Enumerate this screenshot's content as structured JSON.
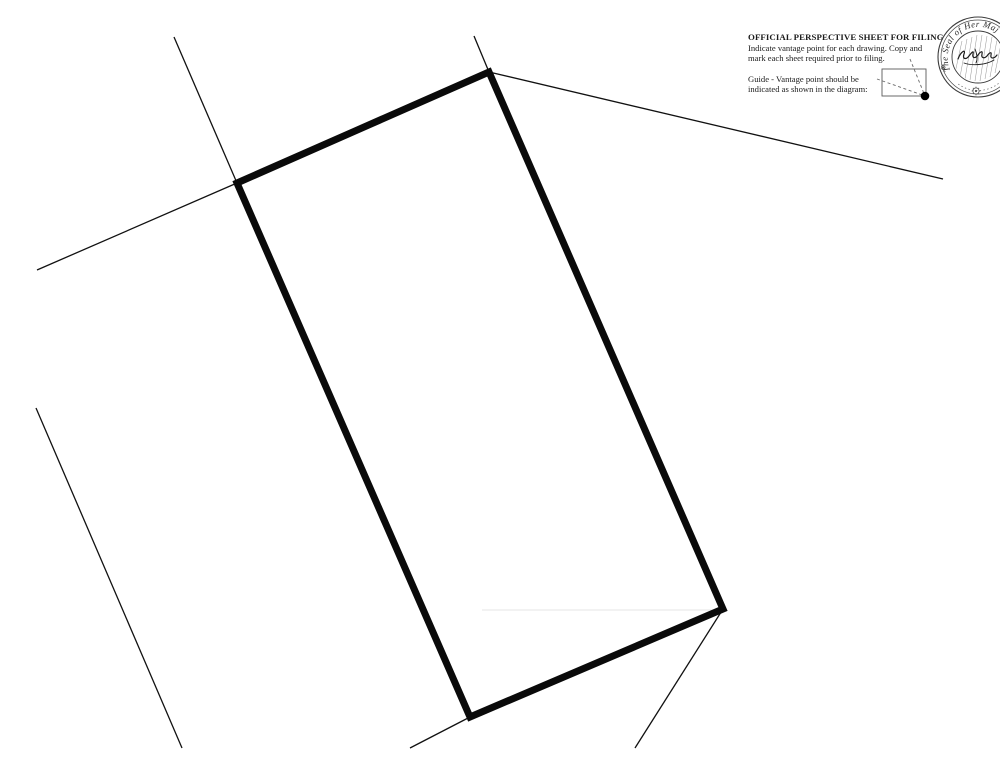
{
  "page": {
    "background": "#ffffff",
    "ink_color": "#0a0a0a"
  },
  "header": {
    "title": "OFFICIAL PERSPECTIVE SHEET FOR FILING",
    "line1": "Indicate vantage point for each drawing. Copy and",
    "line2": "mark each sheet required prior to filing.",
    "guide_line1": "Guide - Vantage point should be",
    "guide_line2": "indicated as shown in the diagram:"
  },
  "seal": {
    "arc_text": "The Seal of Her Maj",
    "ornament": "⊕"
  },
  "drawing": {
    "stroke_color": "#0a0a0a",
    "thin_stroke_color": "#111111",
    "rect_stroke_width": 7,
    "thin_stroke_width": 1.3,
    "rect_corners": [
      [
        237,
        183
      ],
      [
        489,
        72
      ],
      [
        723,
        609
      ],
      [
        470,
        717
      ]
    ],
    "thin_lines": [
      [
        174,
        37,
        237,
        183
      ],
      [
        37,
        270,
        237,
        183
      ],
      [
        474,
        36,
        489,
        72
      ],
      [
        489,
        72,
        943,
        179
      ],
      [
        36,
        408,
        182,
        748
      ],
      [
        723,
        609,
        635,
        748
      ],
      [
        410,
        748,
        470,
        717
      ]
    ],
    "faint_line": [
      482,
      610,
      723,
      610
    ],
    "faint_color": "#e6e6e6"
  }
}
